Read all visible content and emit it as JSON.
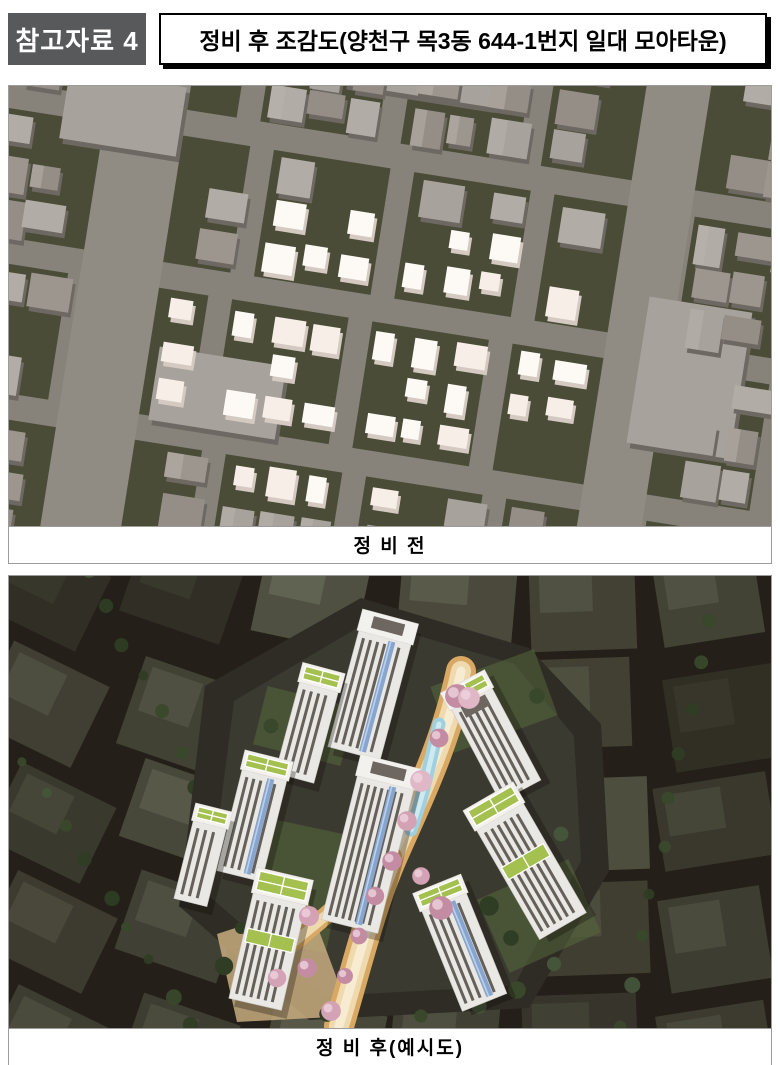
{
  "header": {
    "badge": "참고자료 4",
    "title": "정비 후 조감도(양천구 목3동 644-1번지 일대 모아타운)"
  },
  "figures": {
    "before": {
      "caption": "정 비 전"
    },
    "after": {
      "caption": "정 비 후(예시도)"
    }
  },
  "colors": {
    "badge_bg": "#58595b",
    "badge_text": "#ffffff",
    "title_border": "#000000",
    "before": {
      "street": "#87827a",
      "main_street": "#908b83",
      "ground": "#4a4c38",
      "gray_tops": [
        "#a8a29c",
        "#9c968f",
        "#b2aca6",
        "#948e87"
      ],
      "gray_side": "#6e6862",
      "white_tops": [
        "#fdfaf5",
        "#f6eee7"
      ],
      "white_side": "#d5cac2"
    },
    "after": {
      "background": "#242019",
      "block": "#767a64",
      "block_light": "#9aa087",
      "site_ground": "#2e2c25",
      "tower_body": "#eae8e4",
      "window_stripe": "#56514a",
      "glass_blue": "#87a5cf",
      "glass_blue_light": "#bad1ea",
      "roof_white": "#f3f1ed",
      "roof_green": "#a4c14f",
      "roof_dark": "#6e6761",
      "path_orange": "#d9a964",
      "path_tan": "#efd9ae",
      "path_core": "#f7ecd2",
      "water_blue": "#9fd0df",
      "water_core": "#cfe9f0",
      "terrace_tan": "#c7ab7f",
      "tree_greens": [
        "#39482b",
        "#44553a",
        "#2f3d24"
      ],
      "blossom_pinks": [
        "#d3a2b4",
        "#c48ca3",
        "#e0b7c6"
      ]
    }
  }
}
